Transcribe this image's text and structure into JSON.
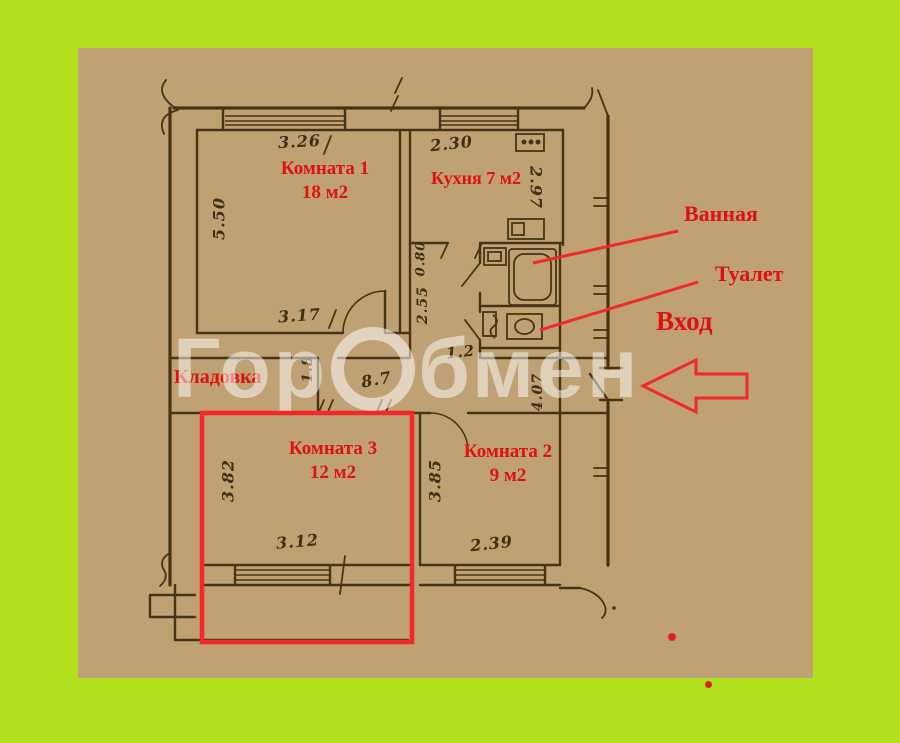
{
  "watermark": {
    "prefix": "Гор",
    "suffix": "бмен"
  },
  "rooms": {
    "room1": {
      "name": "Комната 1",
      "area": "18 м2"
    },
    "kitchen": {
      "name": "Кухня 7 м2"
    },
    "room2": {
      "name": "Комната 2",
      "area": "9 м2"
    },
    "room3": {
      "name": "Комната 3",
      "area": "12 м2"
    },
    "storage": {
      "name": "Кладовка"
    }
  },
  "callouts": {
    "bathroom": "Ванная",
    "toilet": "Туалет",
    "entrance": "Вход"
  },
  "dimensions": {
    "room1_top": "3.26",
    "room1_left": "5.50",
    "room1_bottom": "3.17",
    "kitchen_top": "2.30",
    "kitchen_right": "2.97",
    "corridor_width_a": "0.80",
    "corridor_b": "2.55",
    "corridor_c": "1.8",
    "corridor_d": "8.7",
    "corridor_e": "1.2",
    "entry_hall": "4.07",
    "room3_left": "3.82",
    "room3_bottom": "3.12",
    "room2_left": "3.85",
    "room2_bottom": "2.39"
  },
  "colors": {
    "page_bg": "#b2e01d",
    "scan_bg": "#bfa173",
    "plan_line": "#453516",
    "annotation_red": "#de1212",
    "highlight_red": "#f32828",
    "watermark_white": "rgba(255,255,255,0.5)"
  }
}
